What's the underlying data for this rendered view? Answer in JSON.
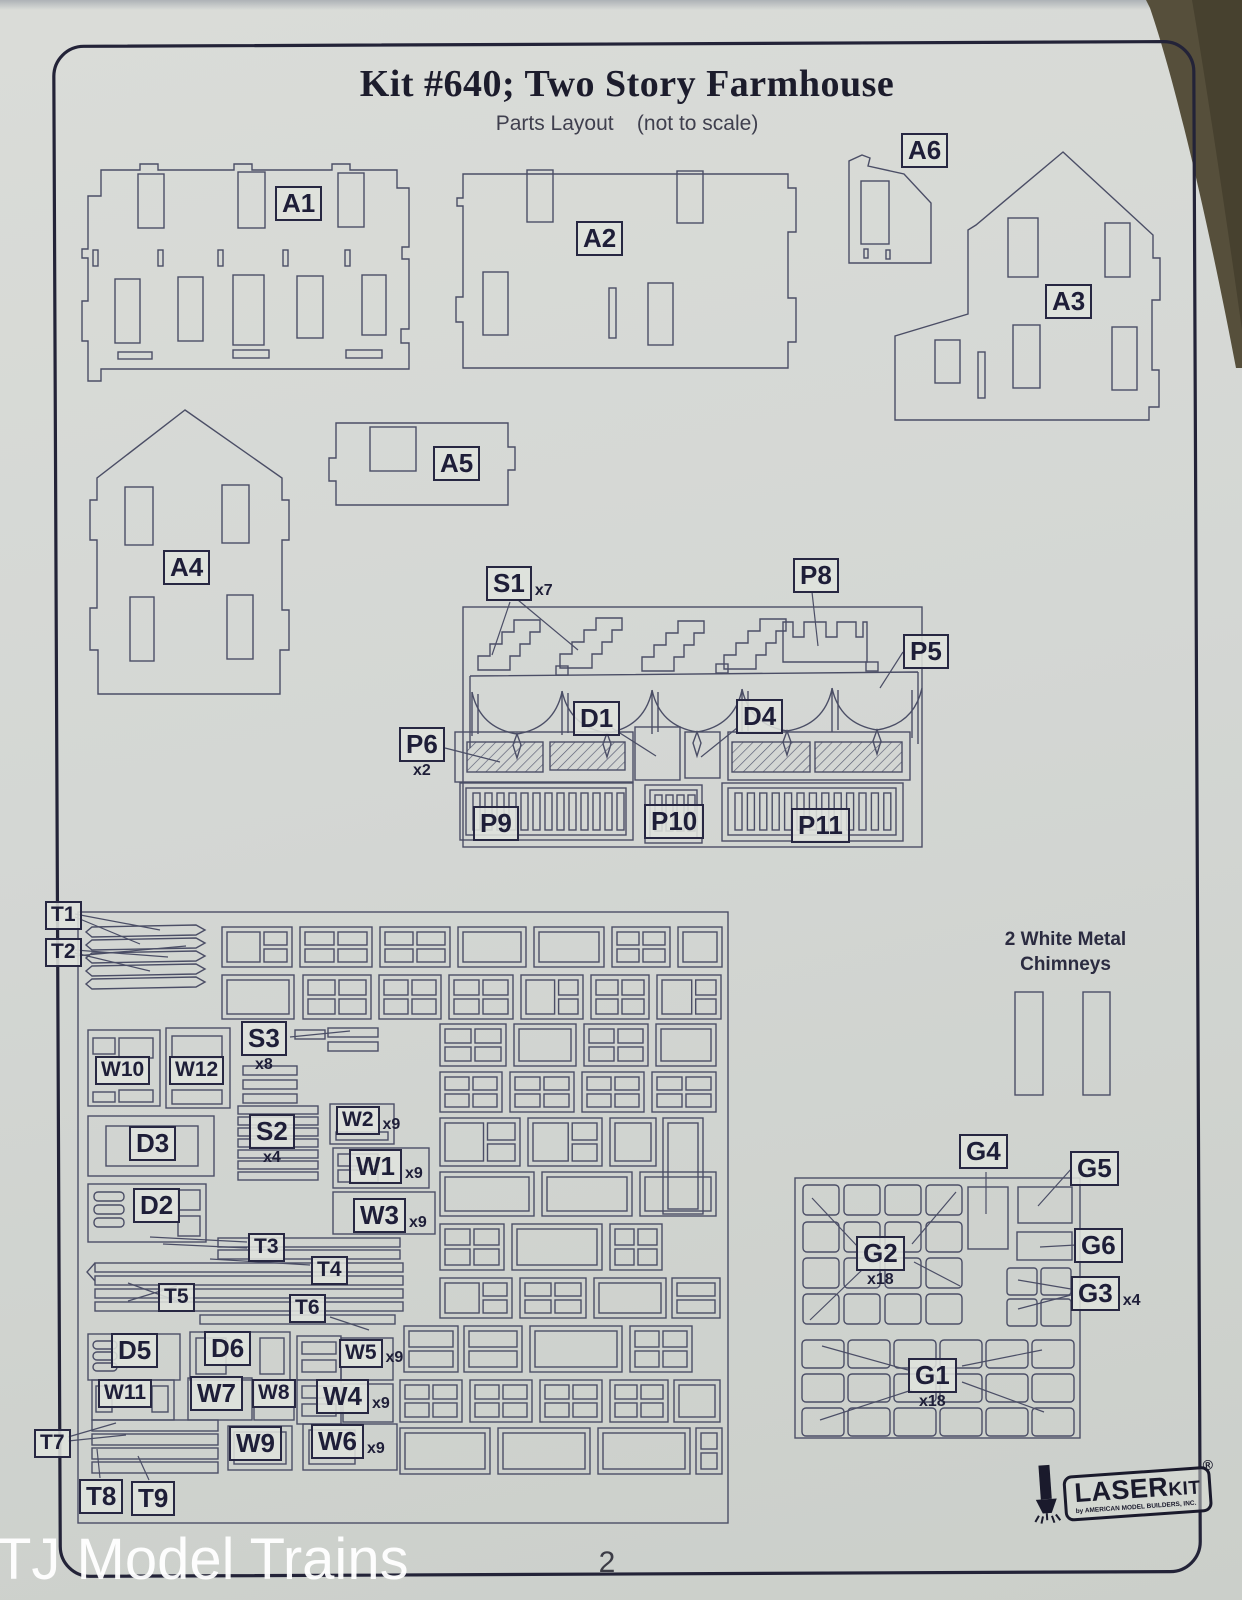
{
  "page": {
    "title": "Kit #640; Two Story Farmhouse",
    "subtitle": "Parts Layout    (not to scale)",
    "page_number": "2",
    "watermark": "TJ Model Trains",
    "chimneys_note": "2 White Metal\nChimneys"
  },
  "logo": {
    "brand_main": "LASER",
    "brand_sub": "KIT",
    "registered": "®",
    "tagline": "by AMERICAN MODEL BUILDERS, INC."
  },
  "colors": {
    "ink": "#4b4e66",
    "label_ink": "#1e1e38",
    "frame": "#232338",
    "paper": "#d4d7d4",
    "backdrop": "#564f3b"
  },
  "part_labels": [
    {
      "id": "A1",
      "text": "A1",
      "x": 275,
      "y": 186
    },
    {
      "id": "A2",
      "text": "A2",
      "x": 576,
      "y": 221
    },
    {
      "id": "A6",
      "text": "A6",
      "x": 901,
      "y": 133
    },
    {
      "id": "A3",
      "text": "A3",
      "x": 1045,
      "y": 284
    },
    {
      "id": "A4",
      "text": "A4",
      "x": 163,
      "y": 550
    },
    {
      "id": "A5",
      "text": "A5",
      "x": 433,
      "y": 446
    },
    {
      "id": "S1",
      "text": "S1",
      "sub": "x7",
      "subpos": "right",
      "x": 486,
      "y": 566
    },
    {
      "id": "P8",
      "text": "P8",
      "x": 793,
      "y": 558
    },
    {
      "id": "P5",
      "text": "P5",
      "x": 903,
      "y": 634
    },
    {
      "id": "P6",
      "text": "P6",
      "sub": "x2",
      "subpos": "below",
      "x": 399,
      "y": 727
    },
    {
      "id": "D1",
      "text": "D1",
      "x": 573,
      "y": 701
    },
    {
      "id": "D4",
      "text": "D4",
      "x": 736,
      "y": 699
    },
    {
      "id": "P9",
      "text": "P9",
      "x": 473,
      "y": 806
    },
    {
      "id": "P10",
      "text": "P10",
      "x": 644,
      "y": 804
    },
    {
      "id": "P11",
      "text": "P11",
      "x": 791,
      "y": 808
    },
    {
      "id": "T1",
      "text": "T1",
      "size": "sm",
      "x": 45,
      "y": 901
    },
    {
      "id": "T2",
      "text": "T2",
      "size": "sm",
      "x": 45,
      "y": 938
    },
    {
      "id": "S3",
      "text": "S3",
      "sub": "x8",
      "subpos": "below",
      "x": 241,
      "y": 1021
    },
    {
      "id": "W10",
      "text": "W10",
      "size": "sm",
      "x": 95,
      "y": 1056
    },
    {
      "id": "W12",
      "text": "W12",
      "size": "sm",
      "x": 169,
      "y": 1056
    },
    {
      "id": "D3",
      "text": "D3",
      "x": 129,
      "y": 1126
    },
    {
      "id": "S2",
      "text": "S2",
      "sub": "x4",
      "subpos": "below",
      "x": 249,
      "y": 1114
    },
    {
      "id": "W2",
      "text": "W2",
      "size": "sm",
      "sub": "x9",
      "subpos": "right",
      "x": 336,
      "y": 1106
    },
    {
      "id": "W1",
      "text": "W1",
      "sub": "x9",
      "subpos": "right",
      "x": 349,
      "y": 1149
    },
    {
      "id": "D2",
      "text": "D2",
      "x": 133,
      "y": 1188
    },
    {
      "id": "W3",
      "text": "W3",
      "sub": "x9",
      "subpos": "right",
      "x": 353,
      "y": 1198
    },
    {
      "id": "T3",
      "text": "T3",
      "size": "sm",
      "x": 248,
      "y": 1233
    },
    {
      "id": "T4",
      "text": "T4",
      "size": "sm",
      "x": 311,
      "y": 1256
    },
    {
      "id": "T5",
      "text": "T5",
      "size": "sm",
      "x": 158,
      "y": 1283
    },
    {
      "id": "T6",
      "text": "T6",
      "size": "sm",
      "x": 289,
      "y": 1294
    },
    {
      "id": "D5",
      "text": "D5",
      "x": 111,
      "y": 1333
    },
    {
      "id": "D6",
      "text": "D6",
      "x": 204,
      "y": 1331
    },
    {
      "id": "W5",
      "text": "W5",
      "size": "sm",
      "sub": "x9",
      "subpos": "right",
      "x": 339,
      "y": 1339
    },
    {
      "id": "W11",
      "text": "W11",
      "size": "sm",
      "x": 98,
      "y": 1379
    },
    {
      "id": "W7",
      "text": "W7",
      "x": 190,
      "y": 1376
    },
    {
      "id": "W8",
      "text": "W8",
      "size": "sm",
      "x": 252,
      "y": 1379
    },
    {
      "id": "W4",
      "text": "W4",
      "sub": "x9",
      "subpos": "right",
      "x": 316,
      "y": 1379
    },
    {
      "id": "T7",
      "text": "T7",
      "size": "sm",
      "x": 34,
      "y": 1429
    },
    {
      "id": "W9",
      "text": "W9",
      "x": 229,
      "y": 1426
    },
    {
      "id": "W6",
      "text": "W6",
      "sub": "x9",
      "subpos": "right",
      "x": 311,
      "y": 1424
    },
    {
      "id": "T8",
      "text": "T8",
      "x": 79,
      "y": 1479
    },
    {
      "id": "T9",
      "text": "T9",
      "x": 131,
      "y": 1481
    },
    {
      "id": "G4",
      "text": "G4",
      "x": 959,
      "y": 1134
    },
    {
      "id": "G5",
      "text": "G5",
      "x": 1070,
      "y": 1151
    },
    {
      "id": "G2",
      "text": "G2",
      "sub": "x18",
      "subpos": "below",
      "x": 856,
      "y": 1236
    },
    {
      "id": "G6",
      "text": "G6",
      "x": 1074,
      "y": 1228
    },
    {
      "id": "G3",
      "text": "G3",
      "sub": "x4",
      "subpos": "right",
      "x": 1071,
      "y": 1276
    },
    {
      "id": "G1",
      "text": "G1",
      "sub": "x18",
      "subpos": "below",
      "x": 908,
      "y": 1358
    }
  ]
}
